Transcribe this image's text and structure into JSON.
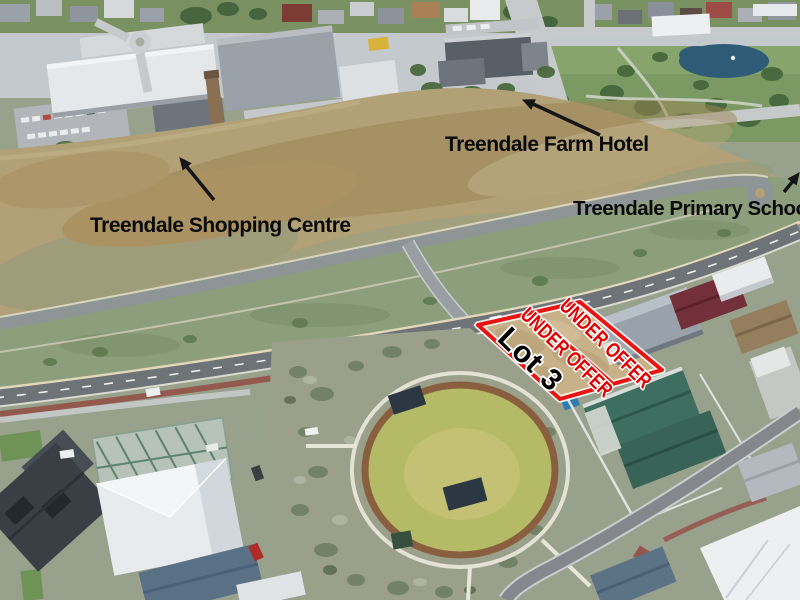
{
  "meta": {
    "description": "Annotated aerial photograph of the Treendale estate showing vacant Lot 3 under offer"
  },
  "annotations": {
    "landmarks": [
      {
        "id": "farm_hotel",
        "label": "Treendale Farm Hotel"
      },
      {
        "id": "shopping_centre",
        "label": "Treendale Shopping Centre"
      },
      {
        "id": "primary_school",
        "label": "Treendale Primary School"
      }
    ],
    "lot": {
      "name": "Lot 3",
      "status_lines": [
        "UNDER OFFER",
        "UNDER OFFER"
      ],
      "outline_color": "#e81414",
      "status_color": "#e10000",
      "name_color": "#000000"
    },
    "arrow_color": "#151515"
  }
}
